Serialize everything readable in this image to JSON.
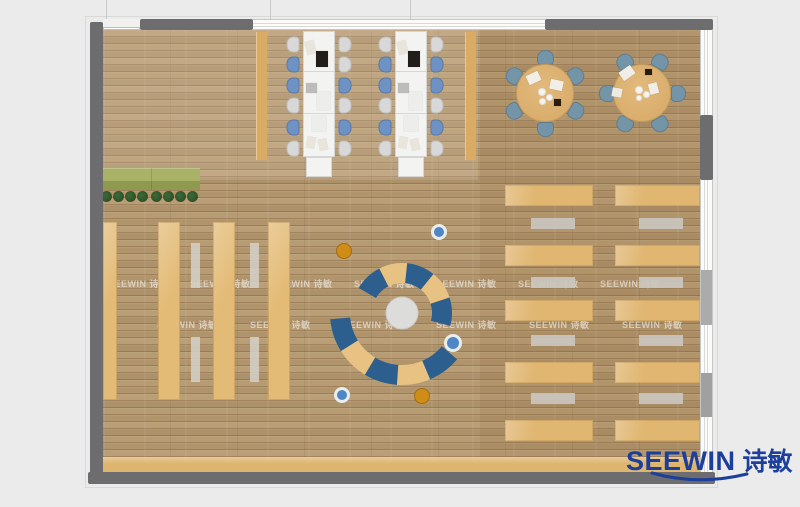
{
  "canvas": {
    "w": 800,
    "h": 507,
    "bg": "#ebebeb"
  },
  "watermark": {
    "text": "SEEWIN 诗敏",
    "color": "rgba(255,255,255,0.55)",
    "rows": [
      {
        "y": 277,
        "xs": [
          108,
          190,
          272,
          354,
          436,
          518,
          600
        ]
      },
      {
        "y": 318,
        "xs": [
          157,
          250,
          343,
          436,
          529,
          622
        ]
      }
    ]
  },
  "logo": {
    "brand": "SEEWIN",
    "cjk": "诗敏",
    "color": "#1c3f9c"
  },
  "floor": {
    "x": 103,
    "y": 30,
    "w": 597,
    "h": 442
  },
  "walls": {
    "color": "#6d6d6f",
    "segments": [
      {
        "name": "top-wall-left",
        "x": 140,
        "y": 19,
        "w": 113,
        "h": 11
      },
      {
        "name": "top-wall-right",
        "x": 545,
        "y": 19,
        "w": 168,
        "h": 11
      },
      {
        "name": "left-wall",
        "x": 90,
        "y": 22,
        "w": 13,
        "h": 462
      },
      {
        "name": "bottom-wall",
        "x": 88,
        "y": 472,
        "w": 627,
        "h": 12
      },
      {
        "name": "right-wall-mid",
        "x": 700,
        "y": 115,
        "w": 13,
        "h": 65
      }
    ],
    "windows": [
      {
        "name": "top-window-band",
        "x": 253,
        "y": 19,
        "w": 292,
        "h": 11,
        "dir": "h"
      },
      {
        "name": "right-window-band",
        "x": 700,
        "y": 29,
        "w": 13,
        "h": 443,
        "dir": "v"
      }
    ],
    "panels": [
      {
        "x": 701,
        "y": 270,
        "w": 11,
        "h": 55,
        "color": "#ababab"
      },
      {
        "x": 701,
        "y": 373,
        "w": 11,
        "h": 44,
        "color": "#a0a0a1"
      }
    ],
    "door": {
      "x": 103,
      "y": 19,
      "w": 37,
      "h": 11,
      "lineY": 27
    },
    "ticks": [
      {
        "x": 106,
        "y": 0,
        "h": 20
      },
      {
        "x": 270,
        "y": 0,
        "h": 19
      },
      {
        "x": 410,
        "y": 0,
        "h": 19
      }
    ]
  },
  "furniture": {
    "stripColor": "#d9ab63",
    "windowStrips": [
      {
        "x": 256,
        "y": 32,
        "w": 11,
        "h": 128
      },
      {
        "x": 465,
        "y": 32,
        "w": 11,
        "h": 128
      }
    ],
    "planter": {
      "x": 103,
      "y": 168,
      "w": 97,
      "topH": 13,
      "botH": 9,
      "topColor": "#a9b266",
      "botColor": "#8d9a50",
      "seamX": 151
    },
    "plants": {
      "cy": 196,
      "r": 5.5,
      "color": "#2d5129",
      "xs": [
        106,
        118,
        130,
        142,
        156,
        168,
        180,
        192
      ]
    },
    "leftShelves": {
      "color": "#e3bb76",
      "y": 222,
      "h": 178,
      "cols": [
        {
          "x": 103,
          "w": 14
        },
        {
          "x": 158,
          "w": 22
        },
        {
          "x": 213,
          "w": 22
        },
        {
          "x": 268,
          "w": 22
        }
      ]
    },
    "leftBenches": {
      "color": "rgba(213,209,201,0.85)",
      "w": 9,
      "xs": [
        191,
        250
      ],
      "segs": [
        {
          "y": 243,
          "h": 45
        },
        {
          "y": 337,
          "h": 45
        }
      ]
    },
    "rightShelves": {
      "color": "#e0b671",
      "rows": [
        185,
        245,
        300,
        362,
        420
      ],
      "h": 21,
      "cols": [
        {
          "x": 505,
          "w": 88
        },
        {
          "x": 615,
          "w": 85
        }
      ]
    },
    "rightBenches": {
      "color": "#cac6be",
      "rows": [
        218,
        277,
        335,
        393
      ],
      "h": 11,
      "cols": [
        {
          "x": 531,
          "w": 44
        },
        {
          "x": 639,
          "w": 44
        }
      ]
    },
    "bottomCounter": {
      "x": 100,
      "y": 457,
      "w": 600,
      "h": 15,
      "color": "#ddb56f"
    },
    "deskRows": {
      "w": 32,
      "bodyY": 31,
      "bodyH": 126,
      "seams": [
        71,
        113
      ],
      "capInset": 3,
      "capY": 157,
      "capH": 20,
      "deskColor": "#f3f3f1",
      "deskBorder": "#d6d6d4",
      "chair": {
        "w": 16,
        "h": 13,
        "grayFill": "#d7d8d7",
        "grayEdge": "#bcbdbc",
        "blueFill": "#6e92c4",
        "blueEdge": "#587aa9",
        "ys": [
          38,
          58,
          79,
          99,
          121,
          142
        ],
        "leftDx": -18,
        "rightDx": 34
      },
      "rows": [
        {
          "x": 303,
          "left": [
            "g",
            "b",
            "b",
            "g",
            "b",
            "g"
          ],
          "right": [
            "g",
            "g",
            "b",
            "g",
            "b",
            "g"
          ]
        },
        {
          "x": 395,
          "left": [
            "g",
            "b",
            "b",
            "g",
            "b",
            "g"
          ],
          "right": [
            "g",
            "b",
            "b",
            "g",
            "b",
            "g"
          ]
        }
      ],
      "items": [
        {
          "dx": 3,
          "dy": 41,
          "w": 9,
          "h": 13,
          "rot": -14,
          "c": "#e9e5da"
        },
        {
          "dx": 13,
          "dy": 51,
          "w": 12,
          "h": 16,
          "rot": 0,
          "c": "#211d1b"
        },
        {
          "dx": 3,
          "dy": 83,
          "w": 11,
          "h": 10,
          "rot": 0,
          "c": "#bcbcba"
        },
        {
          "dx": 14,
          "dy": 92,
          "w": 13,
          "h": 18,
          "rot": 0,
          "c": "#ededeb"
        },
        {
          "dx": 9,
          "dy": 116,
          "w": 14,
          "h": 15,
          "rot": 0,
          "c": "#ededeb"
        },
        {
          "dx": 4,
          "dy": 137,
          "w": 8,
          "h": 11,
          "rot": 10,
          "c": "#e9e5da"
        },
        {
          "dx": 16,
          "dy": 139,
          "w": 8,
          "h": 11,
          "rot": -12,
          "c": "#e9e5da"
        }
      ]
    },
    "roundTables": {
      "r": 29,
      "tableColor": "#d9ad6c",
      "tableEdge": "#c69a58",
      "chair": {
        "w": 17,
        "h": 15,
        "fill": "#7494a8",
        "edge": "#5e7d90",
        "dist": 36
      },
      "tables": [
        {
          "cx": 545,
          "cy": 93,
          "angles": [
            30,
            90,
            150,
            210,
            270,
            330
          ]
        },
        {
          "cx": 642,
          "cy": 93,
          "angles": [
            0,
            60,
            120,
            180,
            240,
            300
          ]
        }
      ],
      "props": {
        "rects": [
          {
            "x": 527,
            "y": 73,
            "w": 13,
            "h": 10,
            "rot": -25,
            "c": "#f1eee7"
          },
          {
            "x": 550,
            "y": 80,
            "w": 13,
            "h": 10,
            "rot": 12,
            "c": "#f1eee7"
          },
          {
            "x": 554,
            "y": 99,
            "w": 7,
            "h": 7,
            "rot": 0,
            "c": "#2b1c10"
          },
          {
            "x": 620,
            "y": 68,
            "w": 14,
            "h": 10,
            "rot": -35,
            "c": "#f1eee7"
          },
          {
            "x": 645,
            "y": 69,
            "w": 7,
            "h": 6,
            "rot": 0,
            "c": "#2b1c10"
          },
          {
            "x": 648,
            "y": 84,
            "w": 11,
            "h": 9,
            "rot": 75,
            "c": "#f1eee7"
          },
          {
            "x": 612,
            "y": 88,
            "w": 10,
            "h": 9,
            "rot": 10,
            "c": "#edeae2"
          }
        ],
        "plates": [
          {
            "cx": 542,
            "cy": 92,
            "r": 4
          },
          {
            "cx": 549,
            "cy": 97,
            "r": 3.5
          },
          {
            "cx": 542,
            "cy": 101,
            "r": 3.5
          },
          {
            "cx": 639,
            "cy": 90,
            "r": 4
          },
          {
            "cx": 646,
            "cy": 94,
            "r": 3.5
          },
          {
            "cx": 639,
            "cy": 98,
            "r": 3
          }
        ],
        "plateColor": "#f6f4ef"
      }
    },
    "lounge": {
      "cx": 402,
      "cy": 313,
      "hub": {
        "r": 16,
        "color": "#dcdcda",
        "edge": "#c9c9c7"
      },
      "blue": "#2d5f8e",
      "tan": "#e7c283",
      "arcs": [
        {
          "r1": 30,
          "r2": 50,
          "segs": [
            {
              "a1": 150,
              "a2": 117,
              "c": "blue"
            },
            {
              "a1": 117,
              "a2": 84,
              "c": "tan"
            },
            {
              "a1": 84,
              "a2": 51,
              "c": "blue"
            },
            {
              "a1": 51,
              "a2": 18,
              "c": "tan"
            },
            {
              "a1": 18,
              "a2": -15,
              "c": "blue"
            }
          ]
        },
        {
          "r1": 52,
          "r2": 72,
          "segs": [
            {
              "a1": 185,
              "a2": 212,
              "c": "blue"
            },
            {
              "a1": 212,
              "a2": 239,
              "c": "tan"
            },
            {
              "a1": 239,
              "a2": 266,
              "c": "blue"
            },
            {
              "a1": 266,
              "a2": 293,
              "c": "tan"
            },
            {
              "a1": 293,
              "a2": 320,
              "c": "blue"
            }
          ]
        }
      ],
      "poufs": [
        {
          "cx": 344,
          "cy": 251,
          "r": 8,
          "type": "orange"
        },
        {
          "cx": 439,
          "cy": 232,
          "r": 8,
          "type": "blue"
        },
        {
          "cx": 453,
          "cy": 343,
          "r": 9,
          "type": "blue"
        },
        {
          "cx": 342,
          "cy": 395,
          "r": 8,
          "type": "blue"
        },
        {
          "cx": 422,
          "cy": 396,
          "r": 8,
          "type": "orange"
        }
      ],
      "orange": "#cf8c16",
      "poufBlue": "#4e86c6",
      "ring": "#e9edec"
    }
  }
}
